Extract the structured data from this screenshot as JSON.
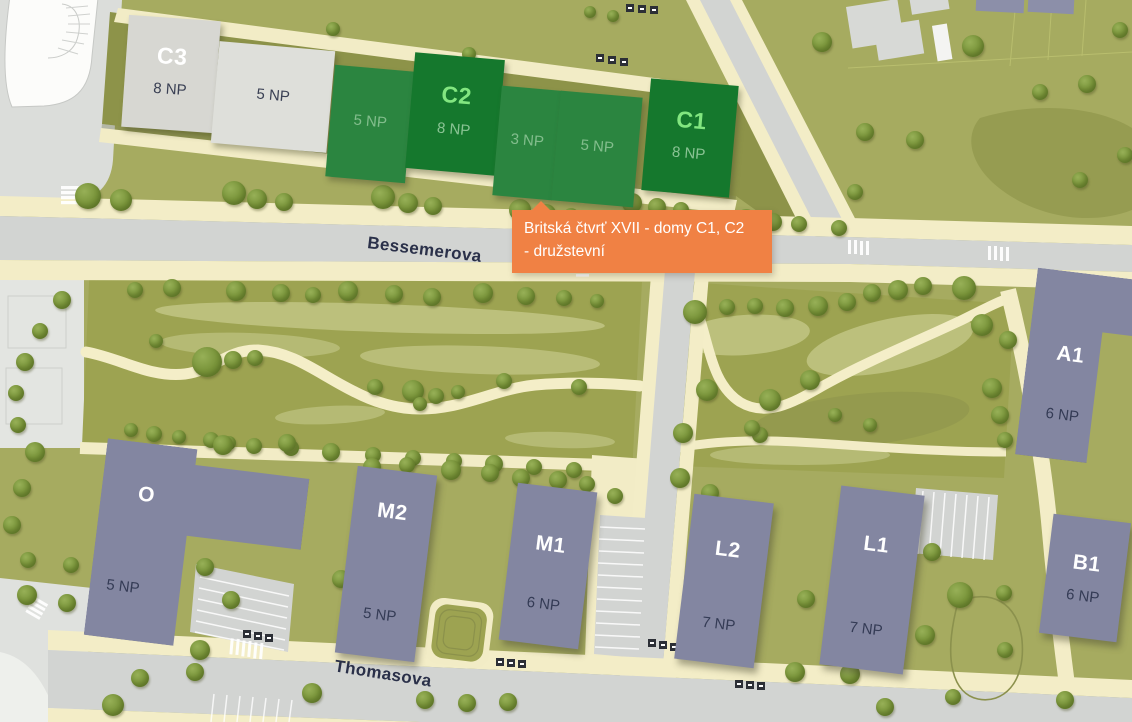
{
  "tooltip": {
    "line1": "Britská čtvrť XVII - domy C1, C2",
    "line2": "- družstevní"
  },
  "streets": {
    "bessemerova": "Bessemerova",
    "thomasova": "Thomasova"
  },
  "strip": [
    {
      "id": "C3",
      "floors": "8 NP",
      "state": "grey"
    },
    {
      "id": "",
      "floors": "5 NP",
      "state": "grey"
    },
    {
      "id": "",
      "floors": "5 NP",
      "state": "green-light"
    },
    {
      "id": "C2",
      "floors": "8 NP",
      "state": "green-dark"
    },
    {
      "id": "",
      "floors": "3 NP",
      "state": "green-light"
    },
    {
      "id": "",
      "floors": "5 NP",
      "state": "green-light"
    },
    {
      "id": "C1",
      "floors": "8 NP",
      "state": "green-dark"
    }
  ],
  "buildings": {
    "o": {
      "id": "O",
      "floors": "5 NP"
    },
    "m2": {
      "id": "M2",
      "floors": "5 NP"
    },
    "m1": {
      "id": "M1",
      "floors": "6 NP"
    },
    "l2": {
      "id": "L2",
      "floors": "7 NP"
    },
    "l1": {
      "id": "L1",
      "floors": "7 NP"
    },
    "a1": {
      "id": "A1",
      "floors": "6 NP"
    },
    "b1": {
      "id": "B1",
      "floors": "6 NP"
    },
    "a_partial": {
      "id": "A"
    }
  },
  "colors": {
    "tooltip_orange": "#f08144",
    "highlight_green_dark": "#15782d",
    "highlight_green_light": "#2b8540",
    "building_grey": "#d7d7d2",
    "building_purple": "#8386a1",
    "grass": "#a6ab60",
    "park_olive": "#9da351",
    "road_grey": "#d2d4d2",
    "sidewalk_cream": "#f3edc7"
  },
  "trees": [
    [
      88,
      196,
      13
    ],
    [
      121,
      200,
      11
    ],
    [
      234,
      193,
      12
    ],
    [
      257,
      199,
      10
    ],
    [
      284,
      202,
      9
    ],
    [
      383,
      197,
      12
    ],
    [
      408,
      203,
      10
    ],
    [
      433,
      206,
      9
    ],
    [
      520,
      210,
      11
    ],
    [
      546,
      214,
      10
    ],
    [
      571,
      216,
      8
    ],
    [
      632,
      203,
      10
    ],
    [
      657,
      207,
      9
    ],
    [
      681,
      210,
      8
    ],
    [
      746,
      219,
      10
    ],
    [
      773,
      222,
      9
    ],
    [
      799,
      224,
      8
    ],
    [
      839,
      228,
      8
    ],
    [
      333,
      29,
      7
    ],
    [
      469,
      54,
      7
    ],
    [
      590,
      12,
      6
    ],
    [
      613,
      16,
      6
    ],
    [
      822,
      42,
      10
    ],
    [
      865,
      132,
      9
    ],
    [
      973,
      46,
      11
    ],
    [
      1040,
      92,
      8
    ],
    [
      1087,
      84,
      9
    ],
    [
      1120,
      30,
      8
    ],
    [
      915,
      140,
      9
    ],
    [
      855,
      192,
      8
    ],
    [
      1080,
      180,
      8
    ],
    [
      1125,
      155,
      8
    ],
    [
      62,
      300,
      9
    ],
    [
      40,
      331,
      8
    ],
    [
      25,
      362,
      9
    ],
    [
      16,
      393,
      8
    ],
    [
      18,
      425,
      8
    ],
    [
      35,
      452,
      10
    ],
    [
      22,
      488,
      9
    ],
    [
      12,
      525,
      9
    ],
    [
      28,
      560,
      8
    ],
    [
      135,
      290,
      8
    ],
    [
      172,
      288,
      9
    ],
    [
      236,
      291,
      10
    ],
    [
      281,
      293,
      9
    ],
    [
      313,
      295,
      8
    ],
    [
      348,
      291,
      10
    ],
    [
      394,
      294,
      9
    ],
    [
      432,
      297,
      9
    ],
    [
      483,
      293,
      10
    ],
    [
      526,
      296,
      9
    ],
    [
      564,
      298,
      8
    ],
    [
      597,
      301,
      7
    ],
    [
      207,
      362,
      15
    ],
    [
      233,
      360,
      9
    ],
    [
      255,
      358,
      8
    ],
    [
      156,
      341,
      7
    ],
    [
      375,
      387,
      8
    ],
    [
      413,
      391,
      11
    ],
    [
      436,
      396,
      8
    ],
    [
      458,
      392,
      7
    ],
    [
      420,
      404,
      7
    ],
    [
      504,
      381,
      8
    ],
    [
      579,
      387,
      8
    ],
    [
      131,
      430,
      7
    ],
    [
      154,
      434,
      8
    ],
    [
      179,
      437,
      7
    ],
    [
      211,
      440,
      8
    ],
    [
      229,
      443,
      7
    ],
    [
      254,
      446,
      8
    ],
    [
      291,
      448,
      8
    ],
    [
      331,
      452,
      9
    ],
    [
      373,
      455,
      8
    ],
    [
      413,
      458,
      8
    ],
    [
      454,
      461,
      8
    ],
    [
      494,
      464,
      9
    ],
    [
      534,
      467,
      8
    ],
    [
      574,
      470,
      8
    ],
    [
      223,
      445,
      10
    ],
    [
      287,
      443,
      9
    ],
    [
      341,
      579,
      9
    ],
    [
      372,
      467,
      9
    ],
    [
      407,
      465,
      8
    ],
    [
      451,
      470,
      10
    ],
    [
      490,
      473,
      9
    ],
    [
      521,
      478,
      9
    ],
    [
      558,
      480,
      9
    ],
    [
      587,
      484,
      8
    ],
    [
      615,
      496,
      8
    ],
    [
      695,
      312,
      12
    ],
    [
      727,
      307,
      8
    ],
    [
      755,
      306,
      8
    ],
    [
      785,
      308,
      9
    ],
    [
      818,
      306,
      10
    ],
    [
      847,
      302,
      9
    ],
    [
      872,
      293,
      9
    ],
    [
      898,
      290,
      10
    ],
    [
      923,
      286,
      9
    ],
    [
      964,
      288,
      12
    ],
    [
      707,
      390,
      11
    ],
    [
      770,
      400,
      11
    ],
    [
      810,
      380,
      10
    ],
    [
      760,
      435,
      8
    ],
    [
      683,
      433,
      10
    ],
    [
      752,
      428,
      8
    ],
    [
      835,
      415,
      7
    ],
    [
      870,
      425,
      7
    ],
    [
      982,
      325,
      11
    ],
    [
      1008,
      340,
      9
    ],
    [
      992,
      388,
      10
    ],
    [
      1000,
      415,
      9
    ],
    [
      1005,
      440,
      8
    ],
    [
      680,
      478,
      10
    ],
    [
      710,
      493,
      9
    ],
    [
      806,
      599,
      9
    ],
    [
      850,
      674,
      10
    ],
    [
      932,
      552,
      9
    ],
    [
      960,
      595,
      13
    ],
    [
      1004,
      593,
      8
    ],
    [
      925,
      635,
      10
    ],
    [
      1005,
      650,
      8
    ],
    [
      27,
      595,
      10
    ],
    [
      67,
      603,
      9
    ],
    [
      71,
      565,
      8
    ],
    [
      205,
      567,
      9
    ],
    [
      231,
      600,
      9
    ],
    [
      200,
      650,
      10
    ],
    [
      113,
      705,
      11
    ],
    [
      140,
      678,
      9
    ],
    [
      195,
      672,
      9
    ],
    [
      312,
      693,
      10
    ],
    [
      425,
      700,
      9
    ],
    [
      467,
      703,
      9
    ],
    [
      508,
      702,
      9
    ],
    [
      733,
      626,
      11
    ],
    [
      795,
      672,
      10
    ],
    [
      885,
      707,
      9
    ],
    [
      953,
      697,
      8
    ],
    [
      1065,
      700,
      9
    ]
  ]
}
